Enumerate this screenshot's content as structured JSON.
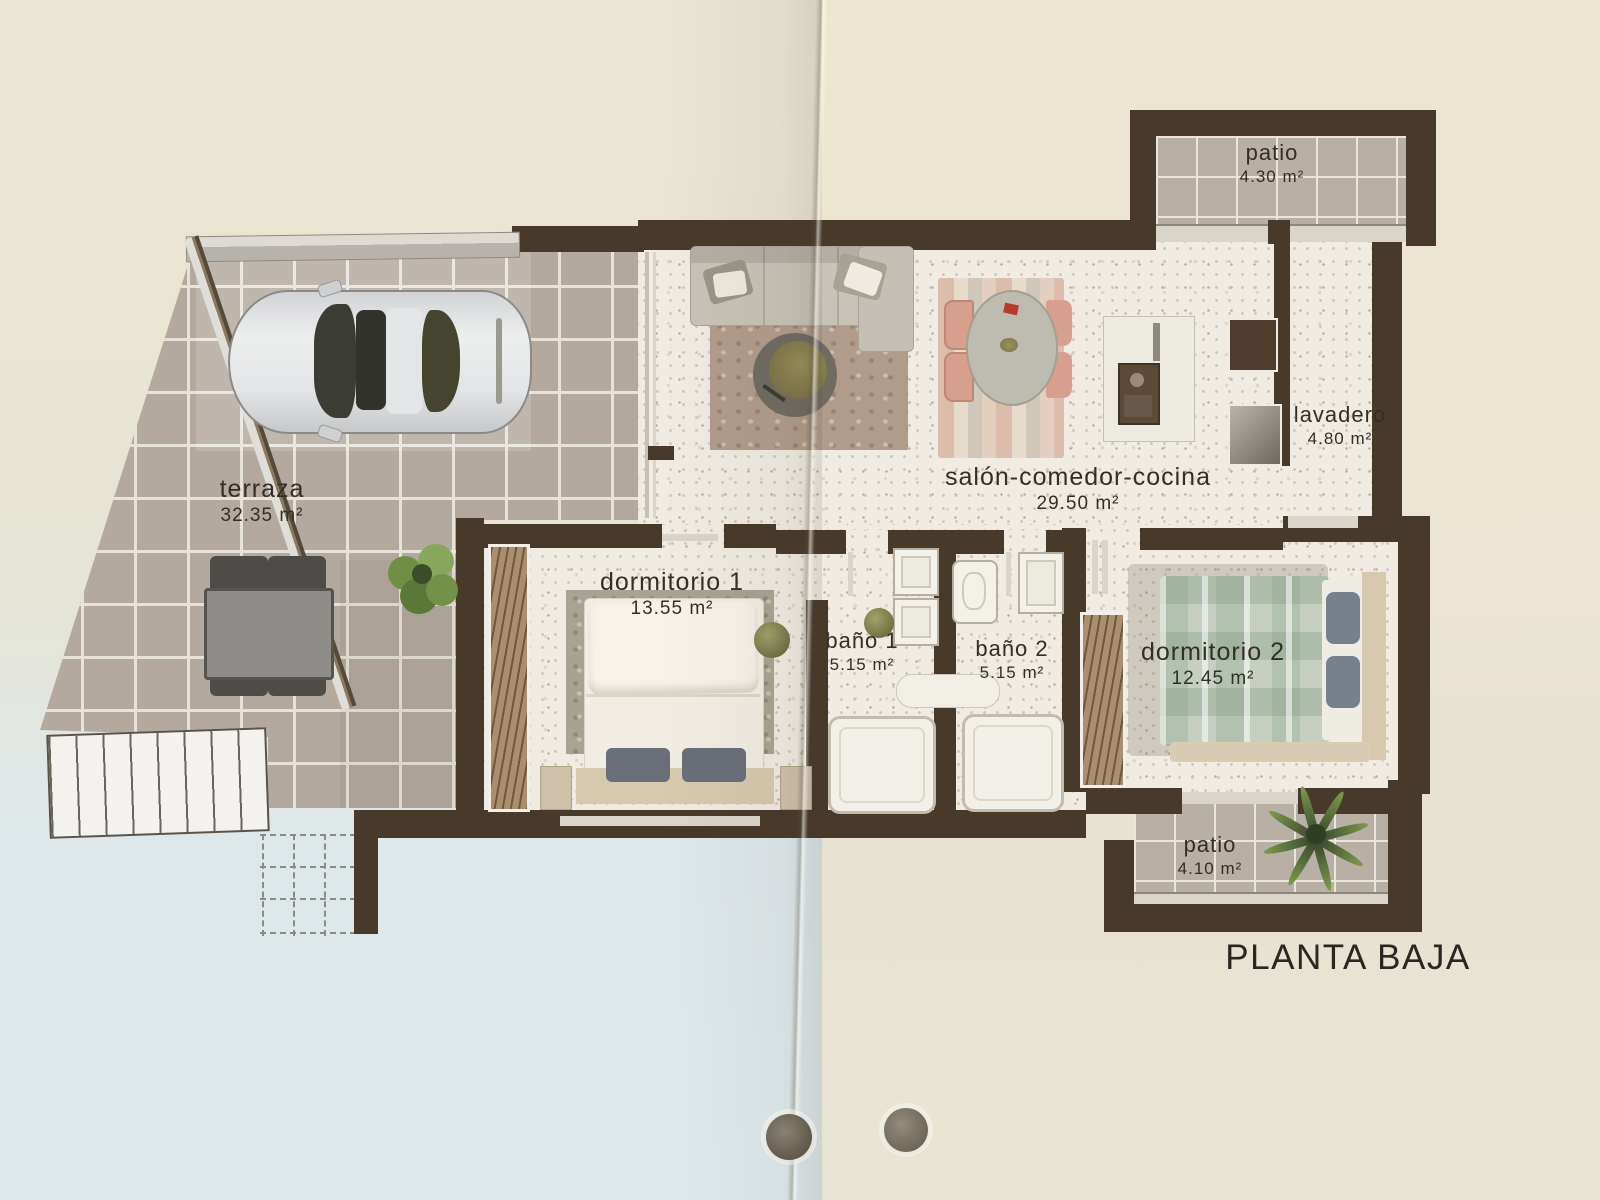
{
  "document": {
    "title": "PLANTA BAJA",
    "kind": "floor-plan-photo",
    "floor_total_rooms": 9
  },
  "rooms": [
    {
      "id": "terraza",
      "name": "terraza",
      "area": "32.35 m²"
    },
    {
      "id": "dormitorio-1",
      "name": "dormitorio 1",
      "area": "13.55 m²"
    },
    {
      "id": "bano-1",
      "name": "baño 1",
      "area": "5.15 m²"
    },
    {
      "id": "bano-2",
      "name": "baño 2",
      "area": "5.15 m²"
    },
    {
      "id": "salon",
      "name": "salón-comedor-cocina",
      "area": "29.50 m²"
    },
    {
      "id": "lavadero",
      "name": "lavadero",
      "area": "4.80 m²"
    },
    {
      "id": "dormitorio-2",
      "name": "dormitorio 2",
      "area": "12.45 m²"
    },
    {
      "id": "patio-top",
      "name": "patio",
      "area": "4.30 m²"
    },
    {
      "id": "patio-bottom",
      "name": "patio",
      "area": "4.10 m²"
    }
  ],
  "furniture": [
    "car",
    "sofa",
    "round-coffee-table",
    "oval-dining-table",
    "dining-chairs-x4",
    "kitchen-counter-sink",
    "refrigerator",
    "washer",
    "double-bed-x2",
    "wardrobe-x2",
    "bathtub-x2",
    "washbasin-x2",
    "toilet",
    "outdoor-table",
    "outdoor-chairs-x4",
    "potted-plant",
    "palm-plant",
    "exterior-stairs"
  ],
  "colors": {
    "wall": "#473a2b",
    "paper_top": "#ebe6d3",
    "paper_bottom_left": "#dfe9ec",
    "paper_bottom_right": "#e8e4d5",
    "outdoor_tile": "#b3a99e",
    "interior_floor": "#f0ece3",
    "label_text": "#332e27"
  }
}
